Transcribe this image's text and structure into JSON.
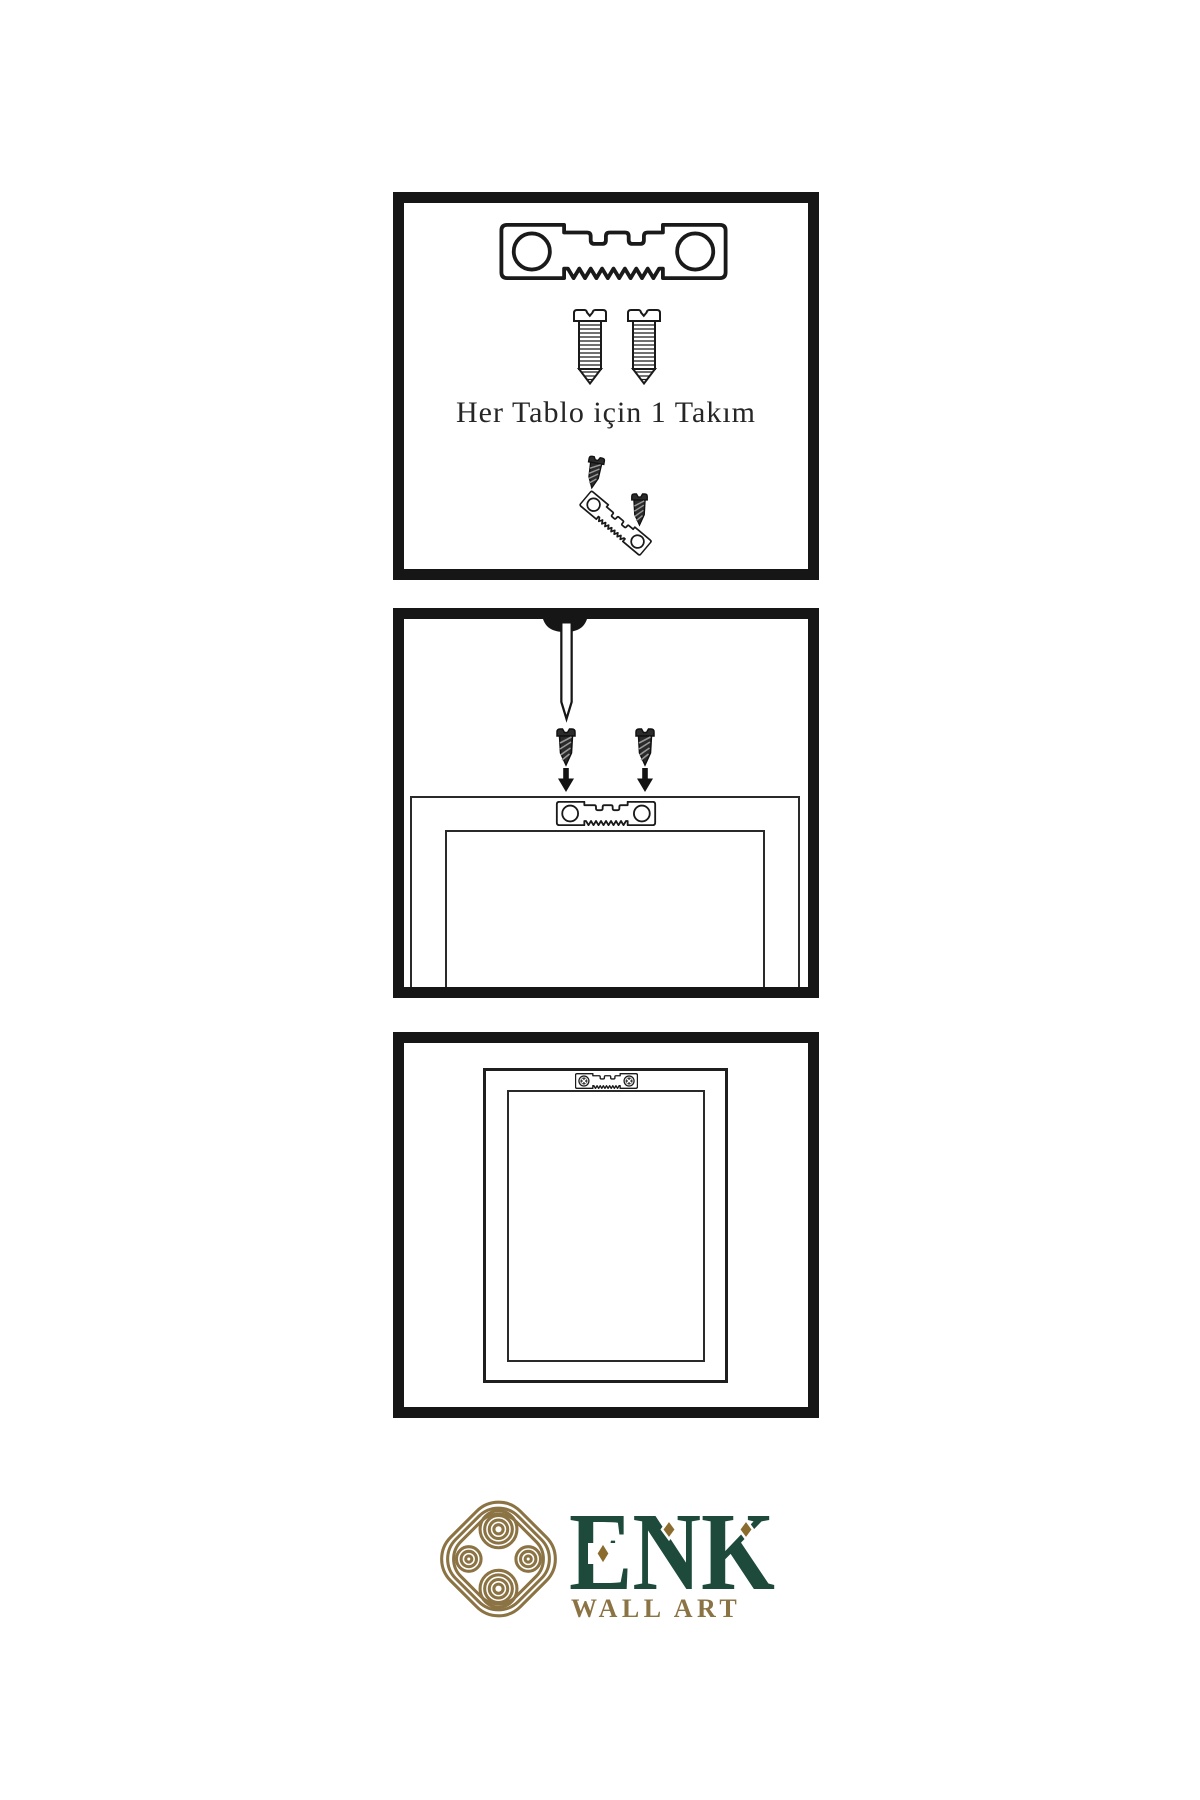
{
  "page": {
    "type": "product-instruction-sheet",
    "background": "#ffffff"
  },
  "colors": {
    "panel_border": "#161616",
    "line_ink": "#1f1f1f",
    "screw_dark": "#2b2b2b",
    "brand_green": "#1d4a3b",
    "brand_gold": "#8b7344",
    "diamond_gold": "#8a6c2e"
  },
  "panel_kit": {
    "caption": "Her Tablo için 1 Takım",
    "icons": [
      "sawtooth-hanger-icon",
      "screw-icon",
      "screw-icon",
      "dark-screw-icon",
      "tilted-sawtooth-hanger-icon",
      "dark-screw-icon"
    ]
  },
  "panel_attach": {
    "icons": [
      "wall-nail-icon",
      "nail-mound-icon",
      "dark-screw-icon",
      "dark-screw-icon",
      "down-arrow-icon",
      "down-arrow-icon",
      "frame-back-icon",
      "sawtooth-hanger-icon"
    ]
  },
  "panel_hang": {
    "icons": [
      "frame-front-icon",
      "mounted-sawtooth-hanger-icon"
    ]
  },
  "logo": {
    "brand": "ENK",
    "tagline": "WALL ART",
    "emblem": "interlocking-knot-icon"
  }
}
